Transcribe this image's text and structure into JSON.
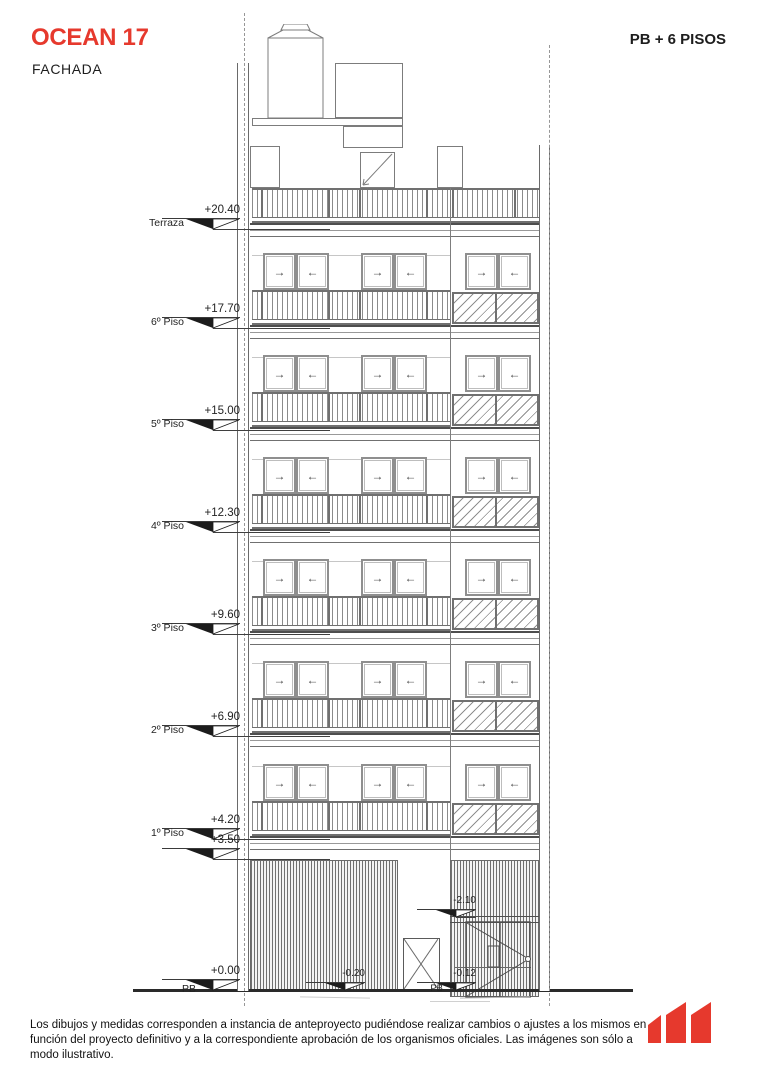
{
  "header": {
    "title": "OCEAN 17",
    "subtitle": "FACHADA",
    "right_label": "PB + 6 PISOS"
  },
  "elevation": {
    "floor_markers": [
      {
        "value": "+20.40",
        "label": "Terraza"
      },
      {
        "value": "+17.70",
        "label": "6º Piso"
      },
      {
        "value": "+15.00",
        "label": "5º Piso"
      },
      {
        "value": "+12.30",
        "label": "4º Piso"
      },
      {
        "value": "+9.60",
        "label": "3º Piso"
      },
      {
        "value": "+6.90",
        "label": "2º Piso"
      },
      {
        "value": "+4.20",
        "label": "1º Piso"
      },
      {
        "value": "+3.50",
        "label": ""
      },
      {
        "value": "+0.00",
        "label": "PB"
      }
    ],
    "ground_markers": [
      {
        "value": "-2.10",
        "label": ""
      },
      {
        "value": "-0.20",
        "label": ""
      },
      {
        "value": "-0.12",
        "label": "PB"
      }
    ],
    "window_arrows": {
      "left": "→",
      "right": "←"
    },
    "icons": [
      "water-tank-icon",
      "stair-door-icon",
      "entrance-door-x-icon",
      "louver-door-icon"
    ]
  },
  "footer": {
    "disclaimer": "Los dibujos y medidas corresponden a instancia de anteproyecto pudiéndose realizar cambios o ajustes a los mismos en función del proyecto definitivo y a la correspondiente aprobación de los organismos oficiales. Las imágenes son sólo a modo ilustrativo.",
    "logo": "m-logo"
  },
  "colors": {
    "accent": "#E6392D",
    "line": "#7D7D7D",
    "dark_line": "#3C3C3C",
    "text": "#1F1F1F"
  }
}
